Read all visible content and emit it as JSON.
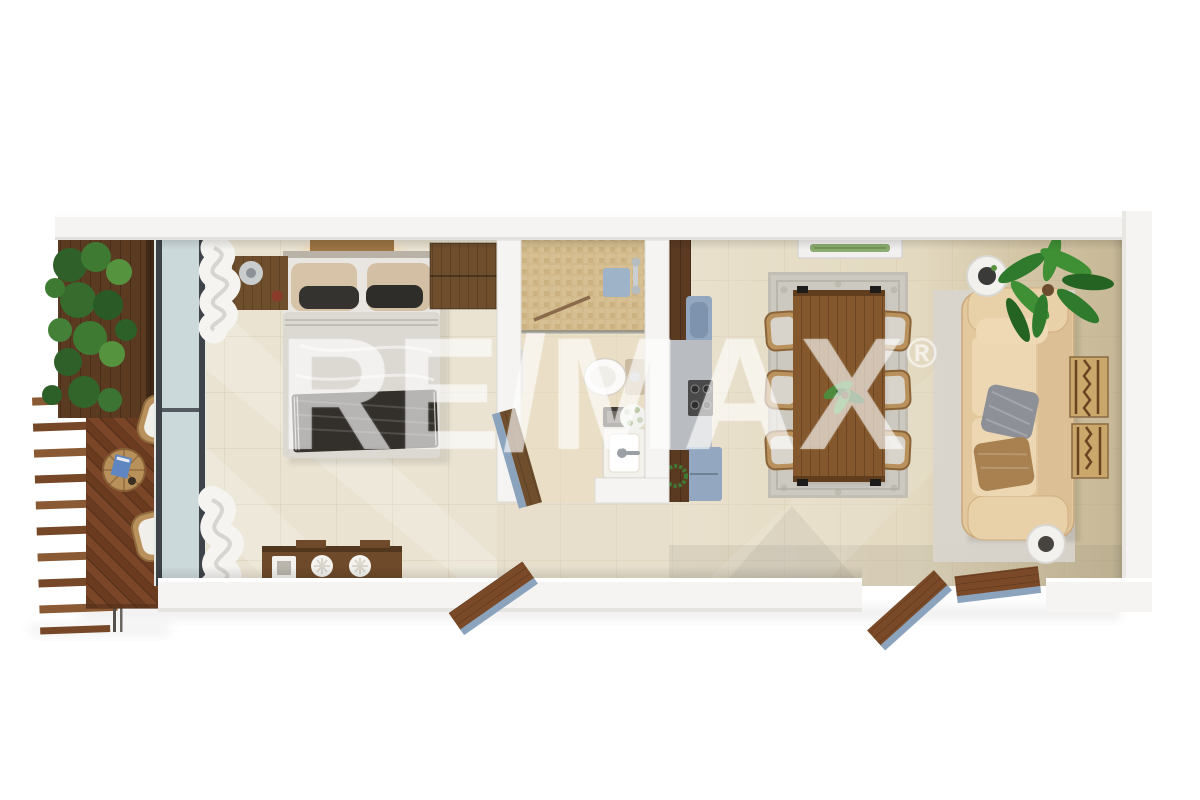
{
  "watermark": {
    "text": "RE/MAX",
    "registered_mark": "®"
  },
  "colors": {
    "background": "#ffffff",
    "wall": "#f5f4f2",
    "wall_edge": "#e2e0dc",
    "floor_bedroom": "#eae3d2",
    "floor_living_tan": "#c9bc9c",
    "floor_bathroom": "#eadfc6",
    "shower_tile": "#cfb687",
    "deck_wood": "#7a4627",
    "furniture_wood_dark": "#6e4e2d",
    "table_wood": "#84582c",
    "wicker": "#b8915c",
    "rug_gray": "#ccc9c1",
    "sofa_beige": "#e3c89e",
    "pillow_gray": "#8d9097",
    "pillow_brown": "#a9804f",
    "appliance_blue": "#93a7c0",
    "counter_gray": "#b9bdc2",
    "plant_green": "#3b7a33",
    "glass_frame": "#3e434a",
    "curtain_white": "#f5f4f1",
    "door_wood": "#7a4a28",
    "door_edge_blue": "#8ba3bd",
    "bed_duvet": "#dcd8d2",
    "throw_dark": "#33302c",
    "watermark": "rgba(255,255,255,0.52)"
  },
  "rooms": [
    {
      "name": "balcony",
      "features": [
        "vertical-garden",
        "wood-slat-wall",
        "herringbone-deck",
        "outdoor-staircase",
        "round-wicker-table",
        "lounge-chair",
        "lounge-chair",
        "glass-sliding-wall"
      ]
    },
    {
      "name": "bedroom",
      "features": [
        "double-bed",
        "headboard-light",
        "nightstand-with-lamp",
        "wardrobe",
        "sheer-curtains",
        "decor-console",
        "swing-door"
      ]
    },
    {
      "name": "bathroom",
      "features": [
        "walk-in-shower",
        "glass-partition",
        "toilet",
        "vanity-sink",
        "flower-vase",
        "swing-door"
      ]
    },
    {
      "name": "kitchen",
      "features": [
        "tall-cabinet",
        "blue-sink-unit",
        "counter",
        "cooktop",
        "refrigerator",
        "base-cabinet",
        "green-wreath"
      ]
    },
    {
      "name": "dining-area",
      "features": [
        "plank-dining-table",
        "wicker-chairs-x6",
        "patterned-rug",
        "plant-centerpiece",
        "ceiling-vent"
      ]
    },
    {
      "name": "living-room",
      "features": [
        "three-seat-sofa",
        "gray-throw-pillow",
        "brown-throw-pillow",
        "round-side-table",
        "round-side-table",
        "potted-plant",
        "wall-hangings",
        "area-rug",
        "double-patio-doors"
      ]
    }
  ]
}
